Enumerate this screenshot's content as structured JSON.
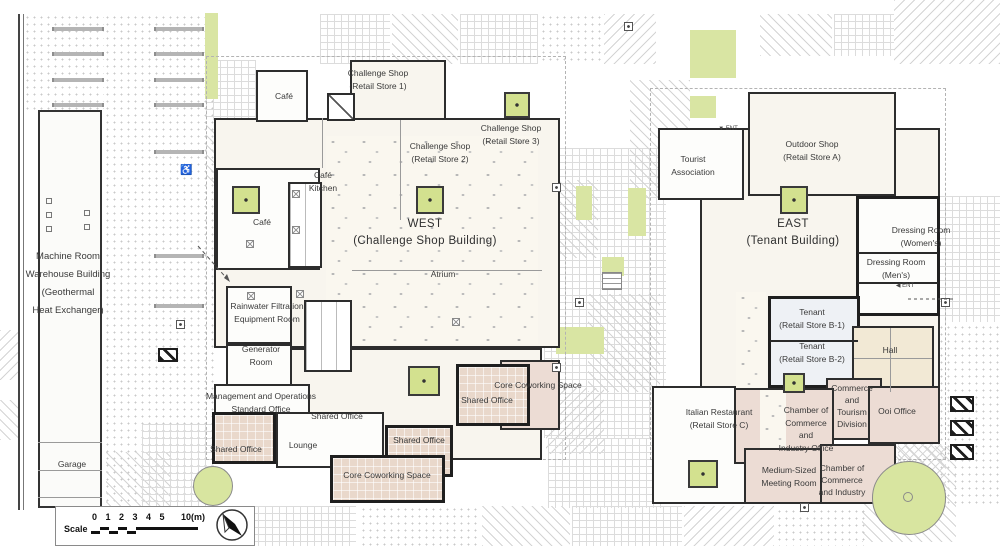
{
  "labels": {
    "machine_room": "Machine Room\nWarehouse Building\n(Geothermal\nHeat Exchanger)",
    "garage": "Garage",
    "cafe_top": "Café",
    "cafe_left": "Café",
    "cafe_kitchen": "Café\nKitchen",
    "challenge_shop_1": "Challenge Shop\n(Retail Store 1)",
    "challenge_shop_2": "Challenge Shop\n(Retail Store 2)",
    "challenge_shop_3": "Challenge Shop\n(Retail Store 3)",
    "west_title": "WEST\n(Challenge Shop Building)",
    "atrium": "Atrium",
    "rainwater": "Rainwater Filtration\nEquipment Room",
    "generator": "Generator\nRoom",
    "management": "Management and Operations\nStandard Office",
    "shared_office_a": "Shared Office",
    "shared_office_left": "Shared Office",
    "lounge": "Lounge",
    "shared_office_mid": "Shared Office",
    "shared_office_right": "Shared Office",
    "core_coworking_bottom": "Core Coworking Space",
    "core_coworking_top": "Core Coworking Space",
    "tourist": "Tourist\nAssociation",
    "outdoor_shop": "Outdoor Shop\n(Retail Store A)",
    "east_title": "EAST\n(Tenant Building)",
    "dressing_women": "Dressing Room\n(Women's)",
    "dressing_men": "Dressing Room\n(Men's)",
    "tenant_b1": "Tenant\n(Retail Store B-1)",
    "tenant_b2": "Tenant\n(Retail Store B-2)",
    "hall": "Hall",
    "commerce_tourism": "Commerce\nand\nTourism\nDivision",
    "ooi_office": "Ooi Office",
    "italian": "Italian Restaurant\n(Retail Store C)",
    "chamber_office": "Chamber of\nCommerce\nand\nIndustry Office",
    "meeting_room": "Medium-Sized\nMeeting Room",
    "chamber_2": "Chamber of\nCommerce\nand Industry",
    "ent": "ENT"
  },
  "scale_bar": {
    "label": "Scale",
    "ticks": "0 1 2 3 4 5",
    "max_label": "10(m)"
  },
  "colors": {
    "wall": "#2d2d2d",
    "planter_green": "#d3e18f",
    "tree_green": "#d8e5a0",
    "office_pink": "#e9d8cb",
    "hall_beige": "#f2e9d5",
    "tenant_blue": "#eef1f5"
  }
}
